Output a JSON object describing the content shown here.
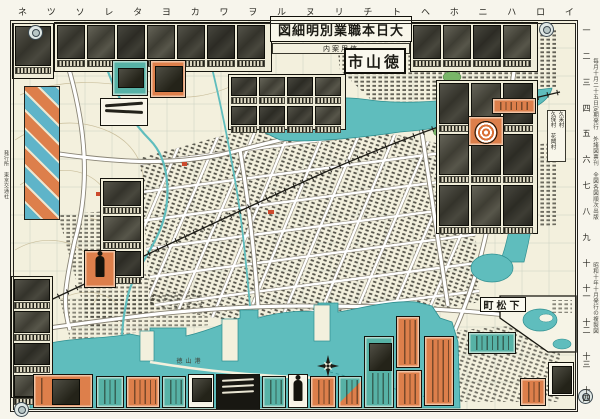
{
  "map_sheet": {
    "series_title": "大日本職業別明細図",
    "subtitle": "信用案内",
    "city_label": "徳山市",
    "place_labels": {
      "kudamatsu": "下松町",
      "villages_line1": "久保村　花岡村",
      "villages_line2": "久米村",
      "port": "徳山港"
    },
    "grid": {
      "kana": [
        "イ",
        "ロ",
        "ハ",
        "ニ",
        "ホ",
        "ヘ",
        "ト",
        "チ",
        "リ",
        "ヌ",
        "ル",
        "ヲ",
        "ワ",
        "カ",
        "ヨ",
        "タ",
        "レ",
        "ソ",
        "ツ",
        "ネ"
      ],
      "numbers": [
        "一",
        "二",
        "三",
        "四",
        "五",
        "六",
        "七",
        "八",
        "九",
        "十",
        "十一",
        "十二",
        "十三",
        "十四"
      ]
    },
    "edge_notes": {
      "right_top": "毎月十月二十五日定期発行　外諸図票刊　全図各図順次出版",
      "right_bottom": "昭和十年十月発行の複製図",
      "left": "発行所　東京交通社"
    },
    "photo_strips": {
      "top_left": 1,
      "top_row_left": 7,
      "top_row_right": 4,
      "under_title": 8,
      "right_column": 9,
      "mid_left": 3,
      "left_lower": 4
    },
    "colors": {
      "paper": "#f3f0dd",
      "water_teal": "#5fbdbd",
      "ad_orange": "#dd7f4b",
      "ad_teal": "#57b2a6",
      "ink": "#1d1c16",
      "park_green": "#79b568"
    }
  }
}
